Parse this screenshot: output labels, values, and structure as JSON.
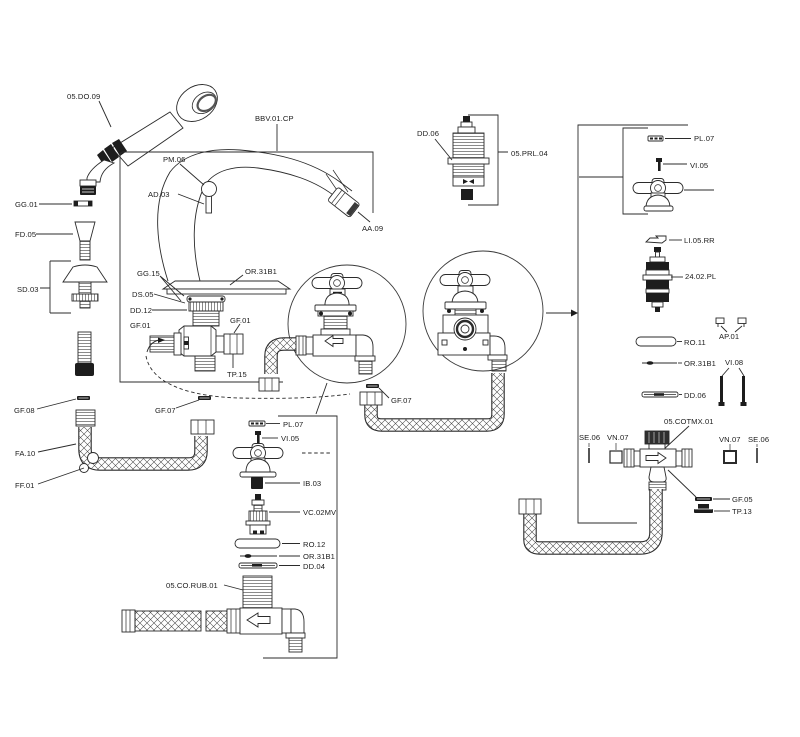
{
  "diagram": {
    "type": "faucet-exploded-parts-diagram",
    "background_color": "#ffffff",
    "line_color": "#2b2b2b"
  },
  "labels": {
    "do09": "05.DO.09",
    "bbv01cp": "BBV.01.CP",
    "pm06": "PM.06",
    "ad03": "AD.03",
    "aa09": "AA.09",
    "gg01": "GG.01",
    "fd05": "FD.05",
    "sd03": "SD.03",
    "gg15": "GG.15",
    "or31b1": "OR.31B1",
    "ds05": "DS.05",
    "dd12": "DD.12",
    "gf01": "GF.01",
    "tp15": "TP.15",
    "gf08": "GF.08",
    "gf07": "GF.07",
    "fa10": "FA.10",
    "ff01": "FF.01",
    "dd06": "DD.06",
    "prl04": "05.PRL.04",
    "pl07": "PL.07",
    "vi05": "VI.05",
    "li05rr": "LI.05.RR",
    "pl2402": "24.02.PL",
    "ap01": "AP.01",
    "ro11": "RO.11",
    "vi08": "VI.08",
    "cotmx01": "05.COTMX.01",
    "se06": "SE.06",
    "vn07": "VN.07",
    "gf05": "GF.05",
    "tp13": "TP.13",
    "ib03": "IB.03",
    "vc02mv": "VC.02MV",
    "ro12": "RO.12",
    "dd04": "DD.04",
    "corub01": "05.CO.RUB.01"
  }
}
